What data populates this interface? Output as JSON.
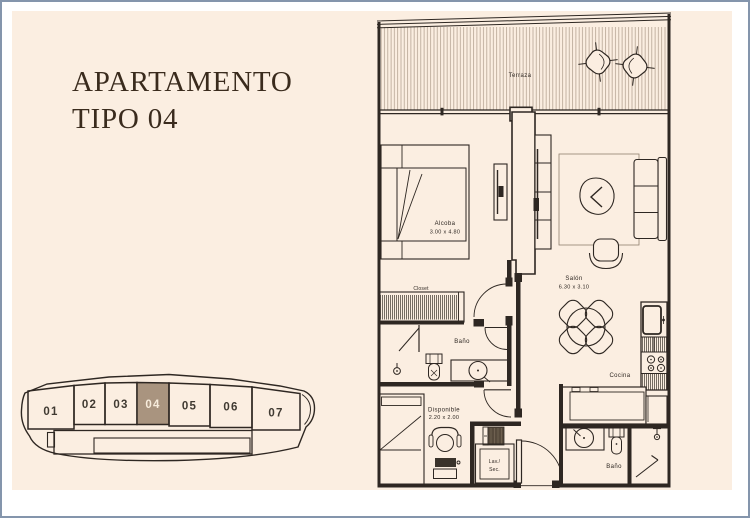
{
  "window": {
    "background": "#FFFFFF",
    "frame_color": "#8495AC",
    "panel_color": "#FBEEE1"
  },
  "title": {
    "line1": "APARTAMENTO",
    "line2": "TIPO 04"
  },
  "building_map": {
    "highlighted_unit": "04",
    "highlight_color": "#A9947F",
    "units": [
      {
        "label": "01"
      },
      {
        "label": "02"
      },
      {
        "label": "03"
      },
      {
        "label": "04"
      },
      {
        "label": "05"
      },
      {
        "label": "06"
      },
      {
        "label": "07"
      }
    ]
  },
  "floor_plan": {
    "line_color": "#2E2722",
    "terraza": {
      "name": "Terraza"
    },
    "alcoba": {
      "name": "Alcoba",
      "dims": "3.00 x 4.80"
    },
    "closet": {
      "name": "Closet"
    },
    "bano_1": {
      "name": "Baño"
    },
    "salon": {
      "name": "Salón",
      "dims": "6.30 x 3.10"
    },
    "cocina": {
      "name": "Cocina"
    },
    "disponible": {
      "name": "Disponible",
      "dims": "2.20 x 2.00"
    },
    "lavanderia": {
      "line1": "Lav./",
      "line2": "Sec."
    },
    "bano_2": {
      "name": "Baño"
    }
  }
}
